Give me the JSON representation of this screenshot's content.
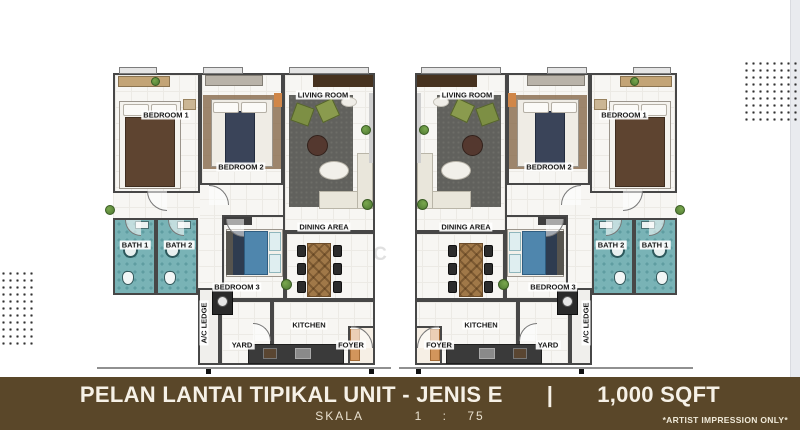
{
  "watermark": "E P I C  H O M E S",
  "rooms": {
    "bedroom1": {
      "label": "BEDROOM 1"
    },
    "bedroom2": {
      "label": "BEDROOM 2"
    },
    "bedroom3": {
      "label": "BEDROOM 3"
    },
    "living": {
      "label": "LIVING ROOM"
    },
    "dining": {
      "label": "DINING AREA"
    },
    "bath1": {
      "label": "BATH 1"
    },
    "bath2": {
      "label": "BATH 2"
    },
    "kitchen": {
      "label": "KITCHEN"
    },
    "yard": {
      "label": "YARD"
    },
    "foyer": {
      "label": "FOYER"
    },
    "ac_ledge": {
      "label": "A/C LEDGE"
    }
  },
  "footer": {
    "title": "PELAN LANTAI TIPIKAL UNIT - JENIS E",
    "divider": "|",
    "area": "1,000 SQFT",
    "scale_label": "SKALA",
    "scale_value": "1 : 75",
    "disclaimer": "*ARTIST IMPRESSION ONLY*"
  },
  "colors": {
    "footer_bg": "#5a4729",
    "bath_teal": "#79b3b6",
    "wood": "#a07848",
    "dots": "#303030",
    "side_stripe": "#e9ebef",
    "bed3_blue": "#4f86ad",
    "rug_gray": "#61615d",
    "foyer_tan": "#d2955c"
  }
}
